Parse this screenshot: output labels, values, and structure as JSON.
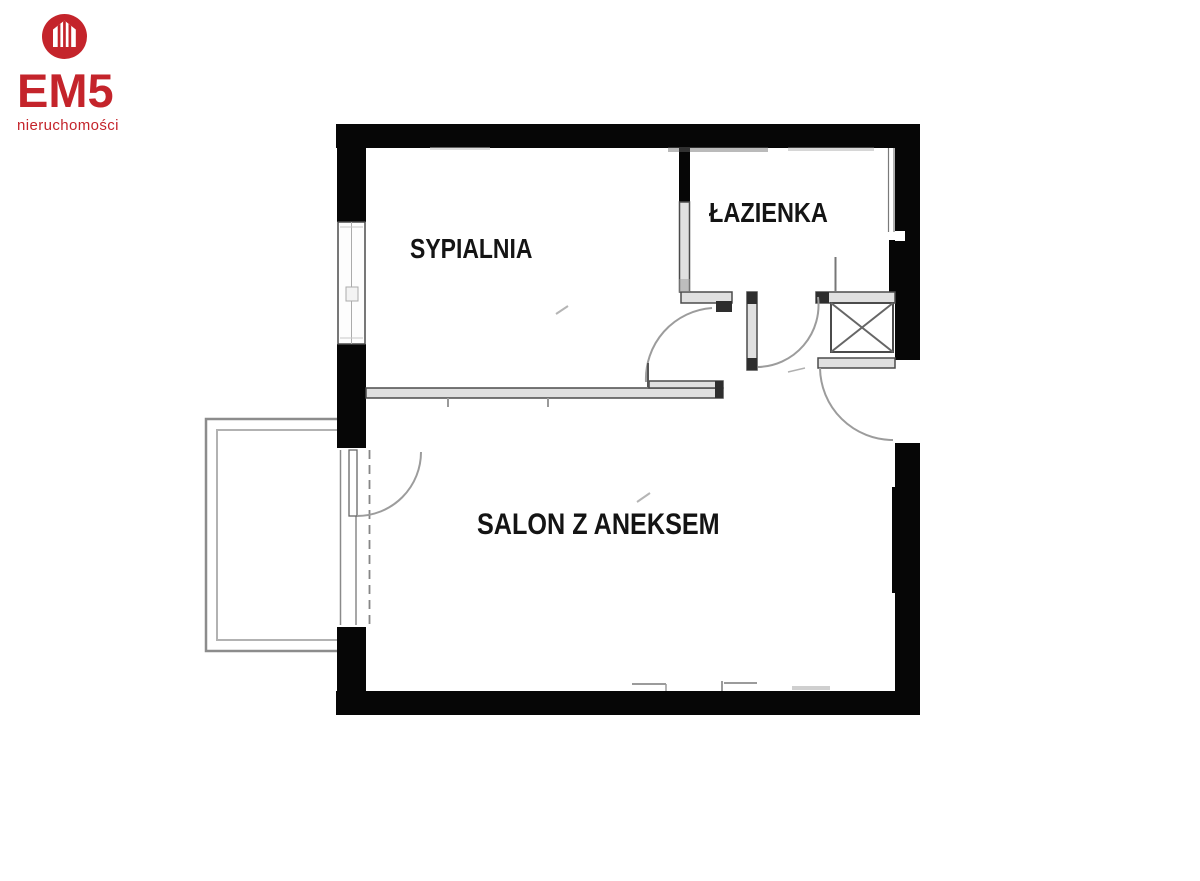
{
  "logo": {
    "brand": "EM5",
    "tagline": "nieruchomości",
    "icon": "house-in-circle-icon",
    "brand_color": "#c4242b"
  },
  "floorplan": {
    "rooms": [
      {
        "id": "sypialnia",
        "label": "SYPIALNIA"
      },
      {
        "id": "lazienka",
        "label": "ŁAZIENKA"
      },
      {
        "id": "salon",
        "label": "SALON Z ANEKSEM"
      }
    ],
    "colors": {
      "wall": "#060606",
      "thin_wall_fill": "#e0e0e0",
      "thin_wall_edge": "#4b4b4b",
      "door_arc": "#9c9c9c",
      "balcony_line": "#8c8c8c"
    },
    "features": {
      "window": "bedroom-window",
      "balcony": "balcony",
      "balcony_door": "balcony-door",
      "bedroom_door": "bedroom-door",
      "bathroom_door": "bathroom-door",
      "entrance_door": "entrance-door",
      "shaft": "ventilation-shaft"
    }
  }
}
